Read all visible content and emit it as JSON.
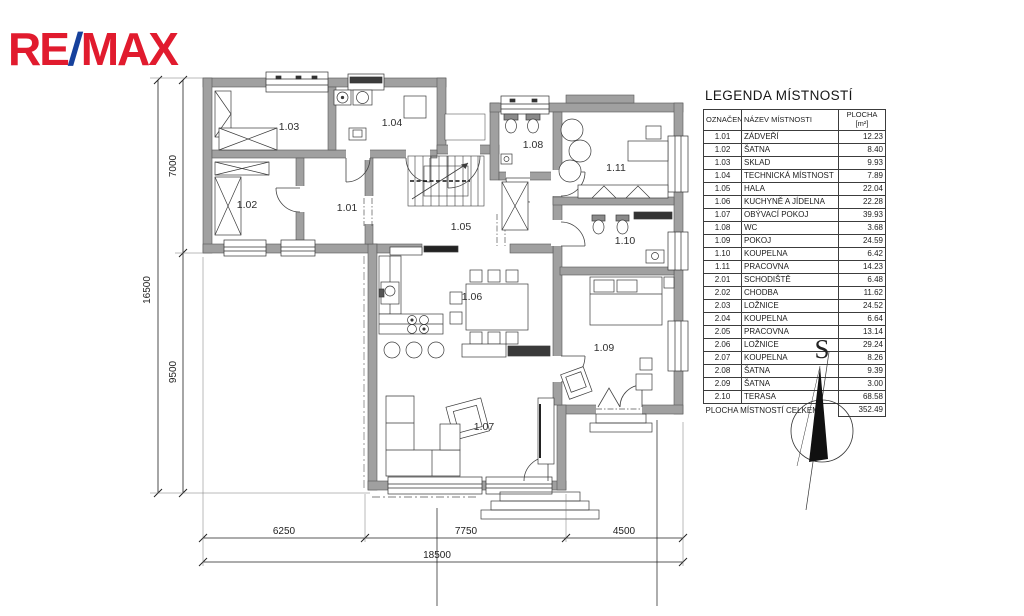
{
  "logo": {
    "part1": "RE",
    "slash": "/",
    "part2": "MAX",
    "red": "#e11b2e",
    "blue": "#16419c"
  },
  "legend": {
    "title": "LEGENDA MÍSTNOSTÍ",
    "columns": {
      "code": "OZNAČENÍ",
      "name": "NÁZEV MÍSTNOSTI",
      "area_line1": "PLOCHA",
      "area_line2": "[m²]"
    },
    "rows": [
      {
        "code": "1.01",
        "name": "ZÁDVEŘÍ",
        "area": "12.23"
      },
      {
        "code": "1.02",
        "name": "ŠATNA",
        "area": "8.40"
      },
      {
        "code": "1.03",
        "name": "SKLAD",
        "area": "9.93"
      },
      {
        "code": "1.04",
        "name": "TECHNICKÁ MÍSTNOST",
        "area": "7.89"
      },
      {
        "code": "1.05",
        "name": "HALA",
        "area": "22.04"
      },
      {
        "code": "1.06",
        "name": "KUCHYNĚ A JÍDELNA",
        "area": "22.28"
      },
      {
        "code": "1.07",
        "name": "OBÝVACÍ POKOJ",
        "area": "39.93"
      },
      {
        "code": "1.08",
        "name": "WC",
        "area": "3.68"
      },
      {
        "code": "1.09",
        "name": "POKOJ",
        "area": "24.59"
      },
      {
        "code": "1.10",
        "name": "KOUPELNA",
        "area": "6.42"
      },
      {
        "code": "1.11",
        "name": "PRACOVNA",
        "area": "14.23"
      },
      {
        "code": "2.01",
        "name": "SCHODIŠTĚ",
        "area": "6.48"
      },
      {
        "code": "2.02",
        "name": "CHODBA",
        "area": "11.62"
      },
      {
        "code": "2.03",
        "name": "LOŽNICE",
        "area": "24.52"
      },
      {
        "code": "2.04",
        "name": "KOUPELNA",
        "area": "6.64"
      },
      {
        "code": "2.05",
        "name": "PRACOVNA",
        "area": "13.14"
      },
      {
        "code": "2.06",
        "name": "LOŽNICE",
        "area": "29.24"
      },
      {
        "code": "2.07",
        "name": "KOUPELNA",
        "area": "8.26"
      },
      {
        "code": "2.08",
        "name": "ŠATNA",
        "area": "9.39"
      },
      {
        "code": "2.09",
        "name": "ŠATNA",
        "area": "3.00"
      },
      {
        "code": "2.10",
        "name": "TERASA",
        "area": "68.58"
      }
    ],
    "total": {
      "label": "PLOCHA MÍSTNOSTÍ CELKEM:",
      "value": "352.49"
    }
  },
  "compass": {
    "north_letter": "S"
  },
  "plan": {
    "rooms": [
      {
        "id": "1.01",
        "x": 347,
        "y": 211
      },
      {
        "id": "1.02",
        "x": 247,
        "y": 208
      },
      {
        "id": "1.03",
        "x": 289,
        "y": 130
      },
      {
        "id": "1.04",
        "x": 392,
        "y": 126
      },
      {
        "id": "1.05",
        "x": 461,
        "y": 230
      },
      {
        "id": "1.06",
        "x": 472,
        "y": 300
      },
      {
        "id": "1.07",
        "x": 484,
        "y": 430
      },
      {
        "id": "1.08",
        "x": 533,
        "y": 148
      },
      {
        "id": "1.09",
        "x": 604,
        "y": 351
      },
      {
        "id": "1.10",
        "x": 625,
        "y": 244
      },
      {
        "id": "1.11",
        "x": 616,
        "y": 171
      }
    ],
    "dimensions": {
      "v_total": "16500",
      "v_top": "7000",
      "v_bottom": "9500",
      "h_left": "6250",
      "h_mid": "7750",
      "h_right": "4500",
      "h_total": "18500"
    }
  }
}
